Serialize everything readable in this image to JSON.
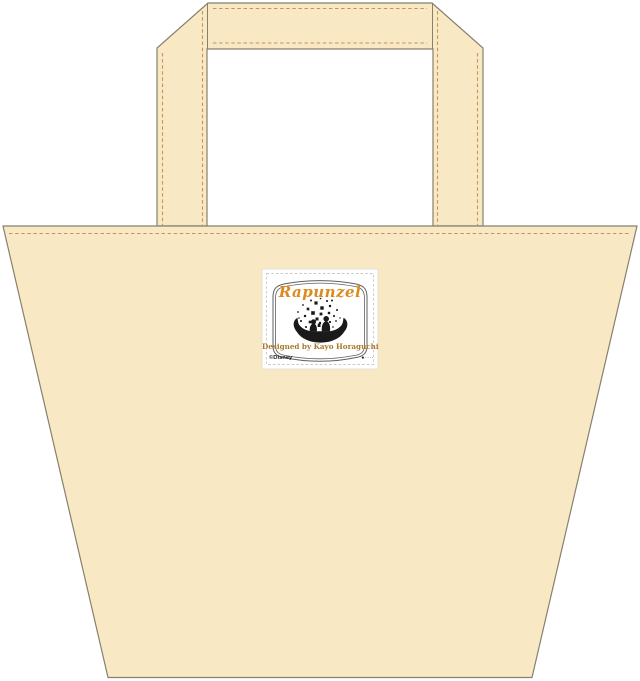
{
  "window": {
    "background_color": "#ffffff"
  },
  "product": {
    "kind": "tote-bag-front-view",
    "fabric_color": "#f9e8c4",
    "outline_color": "#87806d",
    "stitch_color": "#c3945e"
  },
  "label": {
    "title": "Rapunzel",
    "title_color": "#dd8a1c",
    "designer_credit": "Designed by Kayo Horaguchi",
    "credit_color": "#a97a2e",
    "copyright": "©Disney",
    "product_mark": "●····",
    "frame_color": "#5f5f5f",
    "silhouette_color": "#1a1a1a",
    "patch_color": "#ffffff",
    "patch_stitch_color": "#c8c8c8"
  }
}
